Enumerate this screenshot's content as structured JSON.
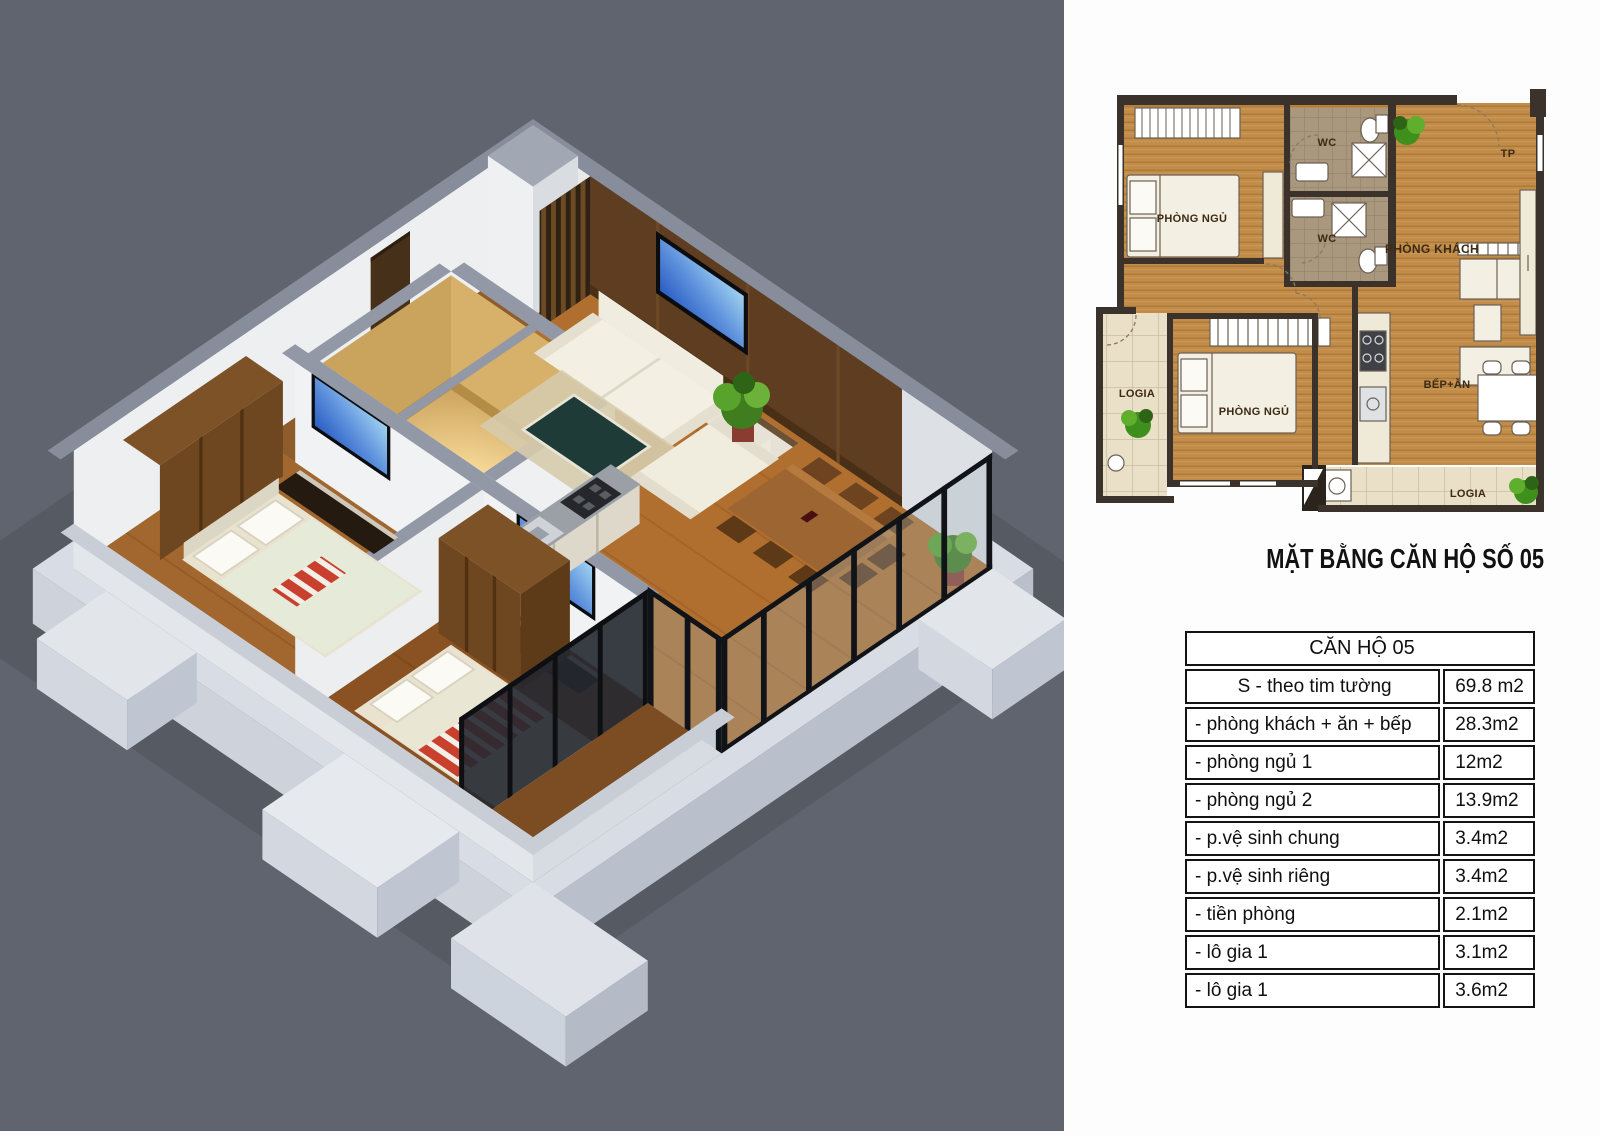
{
  "title": "MẶT BẰNG CĂN HỘ SỐ 05",
  "floor_plan": {
    "labels": {
      "bedroom_top": "PHÒNG NGỦ",
      "wc_top": "WC",
      "wc_bottom": "WC",
      "entry": "TP",
      "living_room": "PHÒNG KHÁCH",
      "logia_left": "LOGIA",
      "bedroom_bottom": "PHÒNG NGỦ",
      "kitchen_dining": "BẾP+ĂN",
      "logia_bottom": "LOGIA"
    }
  },
  "area_table": {
    "header": "CĂN HỘ 05",
    "rows": [
      {
        "label": "S - theo tim tường",
        "value": "69.8 m2"
      },
      {
        "label": "- phòng khách + ăn + bếp",
        "value": "28.3m2"
      },
      {
        "label": "- phòng ngủ 1",
        "value": "12m2"
      },
      {
        "label": "- phòng ngủ 2",
        "value": "13.9m2"
      },
      {
        "label": "- p.vệ sinh chung",
        "value": "3.4m2"
      },
      {
        "label": "- p.vệ sinh riêng",
        "value": "3.4m2"
      },
      {
        "label": "- tiền phòng",
        "value": "2.1m2"
      },
      {
        "label": "- lô gia 1",
        "value": "3.1m2"
      },
      {
        "label": "- lô gia 1",
        "value": "3.6m2"
      }
    ]
  },
  "colors": {
    "background_gray": "#5f646e",
    "plan_wall_dark": "#3b332b",
    "wood_floor": "#c28d4a",
    "accent_red": "#c9402f",
    "plant_green": "#4c8f28",
    "table_border": "#141414"
  }
}
